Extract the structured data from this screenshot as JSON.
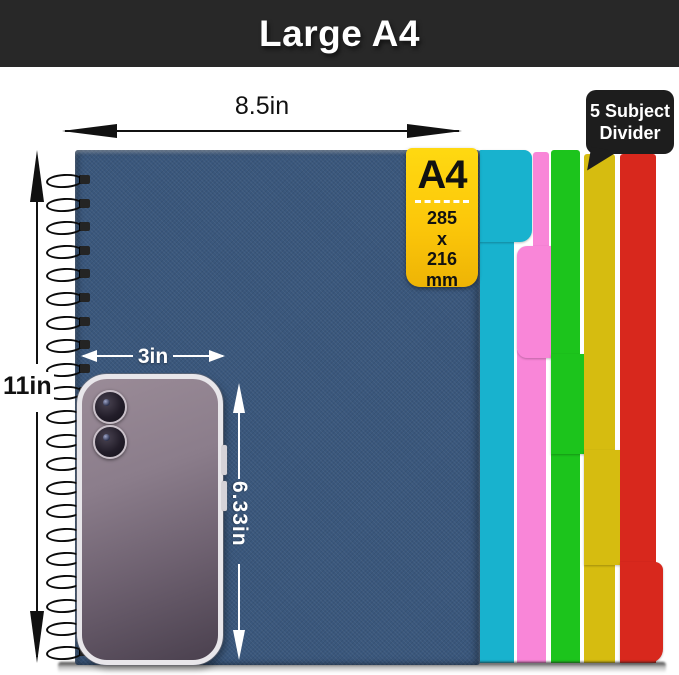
{
  "banner": {
    "title": "Large A4",
    "bg_color": "#282828"
  },
  "annotations": {
    "notebook_width": "8.5in",
    "notebook_height": "11in",
    "phone_width": "3in",
    "phone_height": "6.33in"
  },
  "size_tag": {
    "format": "A4",
    "dimensions": [
      "285",
      "x",
      "216",
      "mm"
    ],
    "bg_color": "#fcc70a"
  },
  "callout": {
    "line1": "5 Subject",
    "line2": "Divider",
    "bg_color": "#1d1d1d"
  },
  "dividers": {
    "count": 5,
    "colors": {
      "cyan": "#18b2ce",
      "pink": "#f986d8",
      "green": "#1cc41c",
      "yellow": "#d6bc10",
      "red": "#d8281d"
    }
  },
  "notebook": {
    "cover_color": "#3a577c",
    "binding_loops": 21
  },
  "phone": {
    "camera_count": 2
  }
}
